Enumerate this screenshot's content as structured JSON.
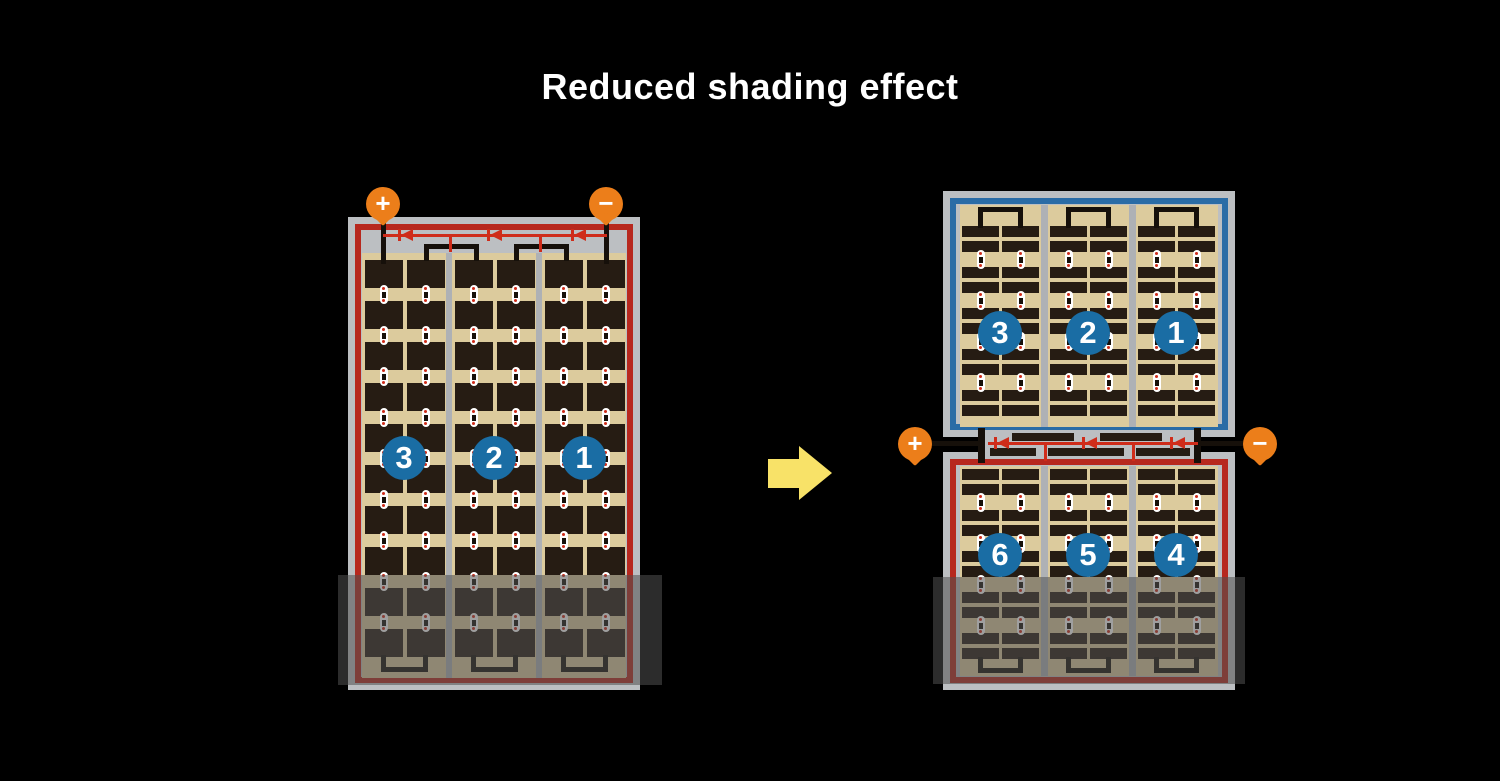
{
  "title": "Reduced shading effect",
  "left_panel": {
    "terminal_plus": "+",
    "terminal_minus": "−",
    "badges": [
      "3",
      "2",
      "1"
    ]
  },
  "right_panel": {
    "terminal_plus": "+",
    "terminal_minus": "−",
    "top_badges": [
      "3",
      "2",
      "1"
    ],
    "bottom_badges": [
      "6",
      "5",
      "4"
    ]
  },
  "icons": {
    "transform_arrow": "right-arrow",
    "diode": "left-pointing-diode"
  },
  "colors": {
    "background": "#000000",
    "panel_frame_gray": "#bcbfc2",
    "divider_gray": "#aeb1b5",
    "cell_background_tan": "#dccb9d",
    "cell_dark": "#261c13",
    "border_red": "#b7281e",
    "diode_red": "#cf2c1a",
    "border_blue": "#2a6ca6",
    "badge_blue": "#1a6da4",
    "terminal_orange": "#ec7e1a",
    "arrow_yellow": "#f8e268",
    "wire_black": "#16100a",
    "connector_white": "#ffffff",
    "shade_overlay": "rgba(80,80,80,0.55)"
  }
}
